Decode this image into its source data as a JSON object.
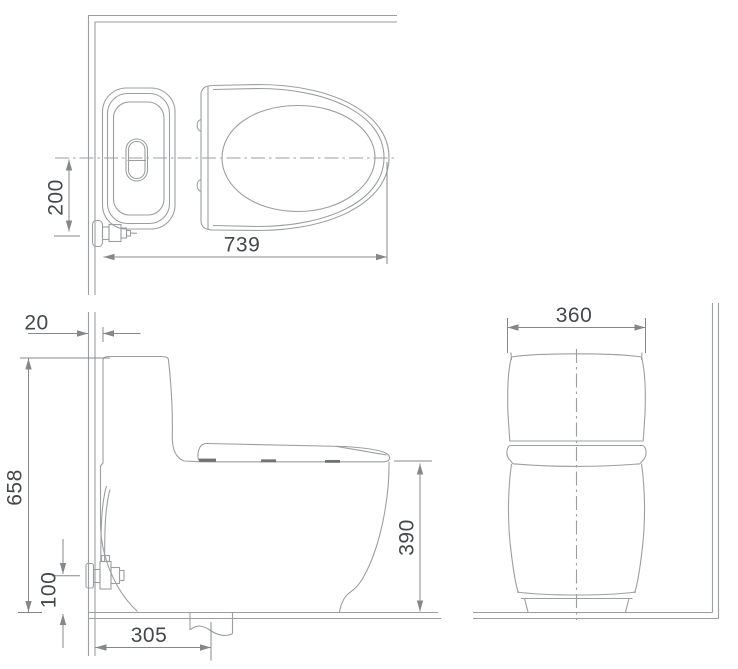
{
  "drawing": {
    "subject": "one-piece toilet technical dimension drawing, three orthographic views",
    "line_color": "#9c9fa1",
    "dim_color": "#84888b",
    "text_color": "#44484b",
    "solid_color": "#6e7275",
    "views": {
      "top": {
        "name": "top view",
        "dimensions": {
          "overall_depth": "739",
          "inlet_offset_from_center": "200"
        }
      },
      "side": {
        "name": "side view",
        "dimensions": {
          "wall_clearance": "20",
          "overall_height": "658",
          "inlet_height": "100",
          "drain_set_out": "305",
          "rim_height": "390"
        }
      },
      "front": {
        "name": "front view",
        "dimensions": {
          "overall_width": "360"
        }
      }
    }
  }
}
